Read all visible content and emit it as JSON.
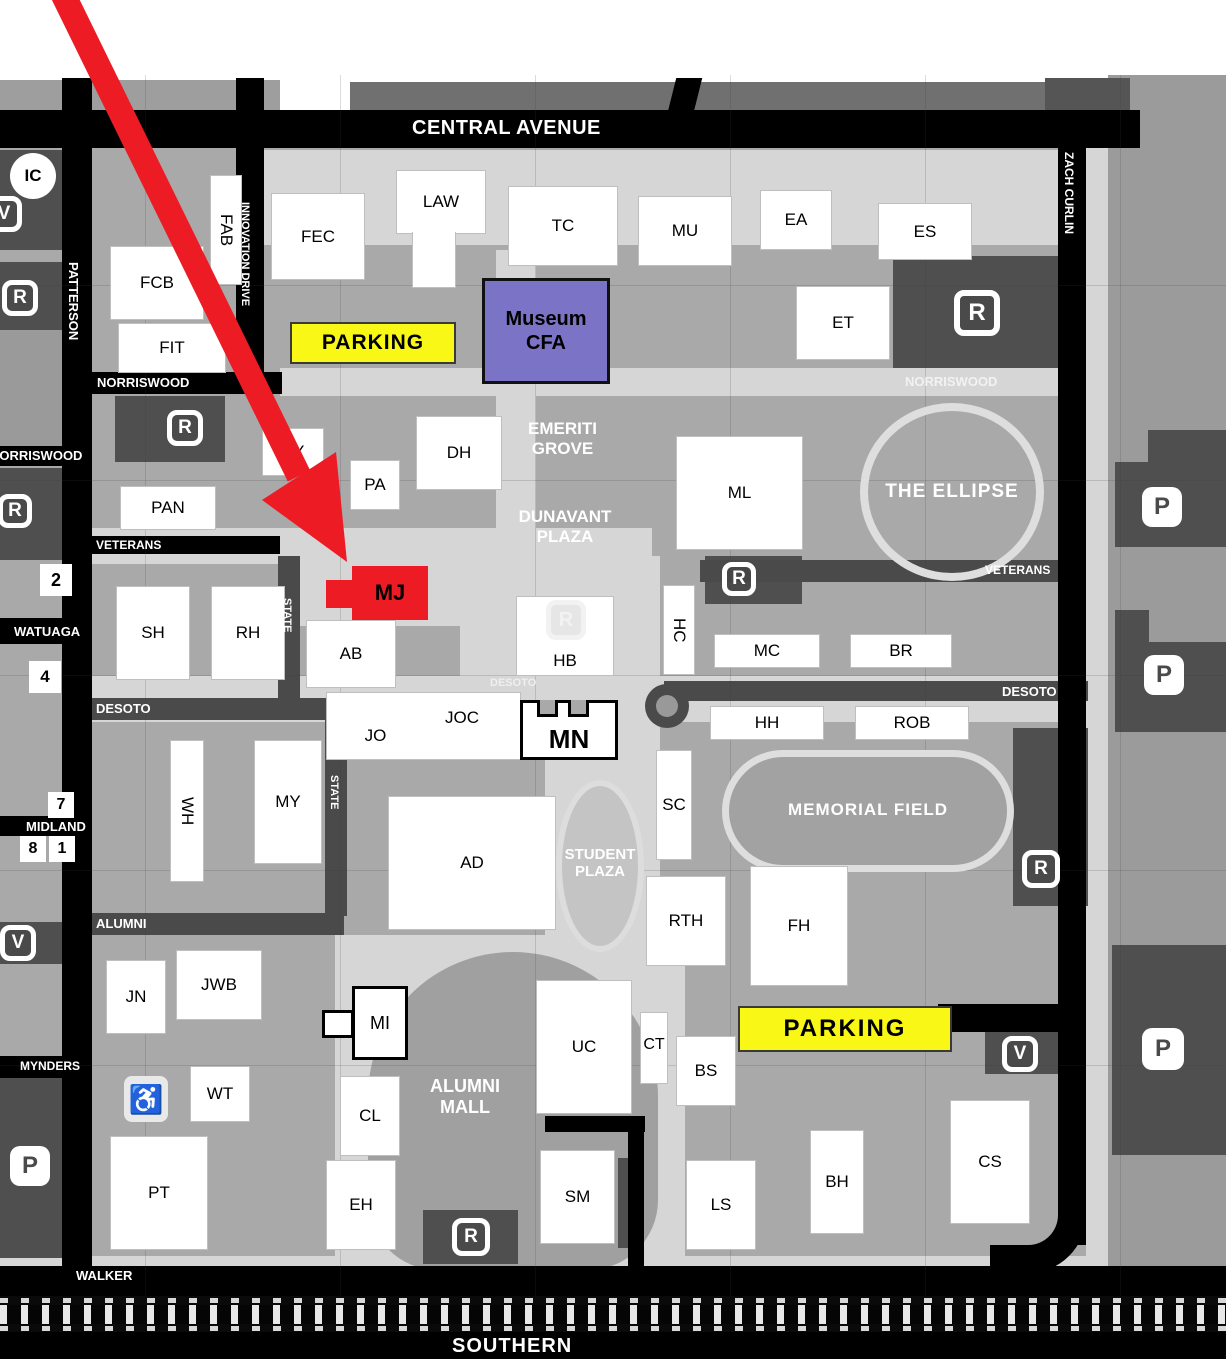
{
  "streets": {
    "central_avenue": "CENTRAL AVENUE",
    "patterson": "PATTERSON",
    "innovation_drive": "INNOVATION DRIVE",
    "zach_curlin": "ZACH CURLIN",
    "norriswood": "NORRISWOOD",
    "veterans": "VETERANS",
    "watauga": "WATUAGA",
    "state": "STATE",
    "desoto": "DESOTO",
    "midland": "MIDLAND",
    "alumni": "ALUMNI",
    "mynders": "MYNDERS",
    "walker": "WALKER",
    "southern": "SOUTHERN"
  },
  "areas": {
    "emeriti_line1": "EMERITI",
    "emeriti_line2": "GROVE",
    "dunavant_line1": "DUNAVANT",
    "dunavant_line2": "PLAZA",
    "student_line1": "STUDENT",
    "student_line2": "PLAZA",
    "mall_line1": "ALUMNI",
    "mall_line2": "MALL",
    "memorial_field": "MEMORIAL FIELD",
    "the_ellipse": "THE ELLIPSE"
  },
  "buildings": {
    "fab": "FAB",
    "fec": "FEC",
    "law": "LAW",
    "tc": "TC",
    "mu": "MU",
    "ea": "EA",
    "es": "ES",
    "fcb": "FCB",
    "fit": "FIT",
    "et": "ET",
    "sy": "SY",
    "pa": "PA",
    "dh": "DH",
    "pan": "PAN",
    "ml": "ML",
    "mj": "MJ",
    "sh": "SH",
    "rh": "RH",
    "ab": "AB",
    "hb": "HB",
    "hc": "HC",
    "mc": "MC",
    "br": "BR",
    "jo": "JO",
    "joc": "JOC",
    "mn": "MN",
    "hh": "HH",
    "rob": "ROB",
    "wh": "WH",
    "my": "MY",
    "sc": "SC",
    "ad": "AD",
    "rth": "RTH",
    "fh": "FH",
    "jn": "JN",
    "jwb": "JWB",
    "mi": "MI",
    "uc": "UC",
    "ct": "CT",
    "bs": "BS",
    "wt": "WT",
    "cl": "CL",
    "pt": "PT",
    "eh": "EH",
    "sm": "SM",
    "ls": "LS",
    "bh": "BH",
    "cs": "CS"
  },
  "museum": {
    "line1": "Museum",
    "line2": "CFA"
  },
  "parking_sign": "PARKING",
  "badges": {
    "r": "R",
    "p": "P",
    "v": "V",
    "ic": "IC",
    "n1": "1",
    "n2": "2",
    "n4": "4",
    "n7": "7",
    "n8": "8",
    "accessible": "♿"
  },
  "colors": {
    "highlight_red": "#ed1c24",
    "museum_purple": "#7b74c6",
    "parking_yellow": "#f8f715"
  }
}
